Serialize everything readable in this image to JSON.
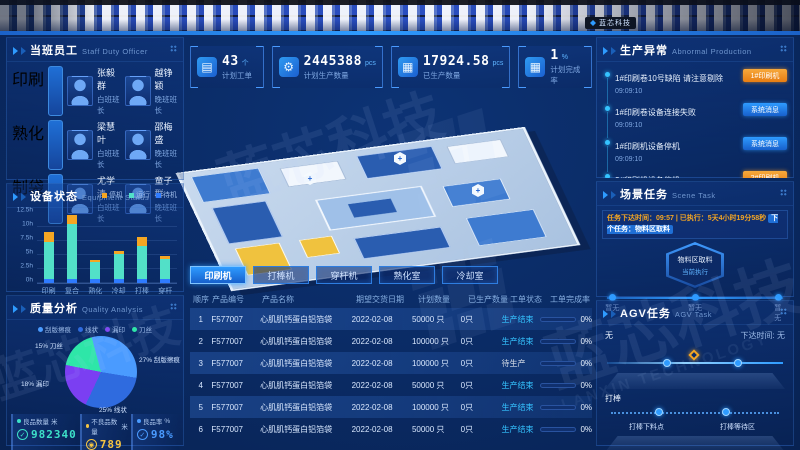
{
  "banner": {
    "logo_text": "蓝芯科技"
  },
  "watermark": {
    "cn": "蓝芯科技",
    "en": "LANXIN TECHNOLOGY"
  },
  "colors": {
    "accent_blue": "#2e9bff",
    "alert_orange": "#f5a623",
    "cyan": "#3de0c8",
    "yellow": "#f5c542",
    "panel_border": "#2f6fd1"
  },
  "staff_panel": {
    "title": "当班员工",
    "subtitle": "Staff Duty Officer",
    "groups": [
      {
        "tag": "印刷",
        "members": [
          {
            "name": "张毅群",
            "role": "白班班长"
          },
          {
            "name": "越铮颖",
            "role": "晚班班长"
          }
        ]
      },
      {
        "tag": "熟化",
        "members": [
          {
            "name": "梁慧叶",
            "role": "白班班长"
          },
          {
            "name": "邵梅盛",
            "role": "晚班班长"
          }
        ]
      },
      {
        "tag": "制袋",
        "members": [
          {
            "name": "尤学清",
            "role": "白班班长"
          },
          {
            "name": "童子群",
            "role": "晚班班长"
          }
        ]
      }
    ]
  },
  "equipment_panel": {
    "title": "设备状态",
    "subtitle": "Equipment Status"
  },
  "quality_panel": {
    "title": "质量分析",
    "subtitle": "Quality Analysis",
    "stats": [
      {
        "label": "良品数量",
        "unit": "米",
        "value": "982340",
        "color": "#3de0c8",
        "icon": "check-circle-icon",
        "glyph": "✓"
      },
      {
        "label": "不良品数量",
        "unit": "米",
        "value": "789",
        "color": "#f5c542",
        "icon": "target-circle-icon",
        "glyph": "◉"
      },
      {
        "label": "良品率",
        "unit": "%",
        "value": "98%",
        "color": "#4a9bff",
        "icon": "check-circle-icon",
        "glyph": "✓"
      }
    ]
  },
  "kpis": [
    {
      "icon": "clipboard-icon",
      "glyph": "▤",
      "value": "43",
      "unit": "个",
      "label": "计划工单"
    },
    {
      "icon": "gear-icon",
      "glyph": "⚙",
      "value": "2445388",
      "unit": "pcs",
      "label": "计划生产数量"
    },
    {
      "icon": "boxes-icon",
      "glyph": "▦",
      "value": "17924.58",
      "unit": "pcs",
      "label": "已生产数量"
    },
    {
      "icon": "boxes-icon",
      "glyph": "▦",
      "value": "1",
      "unit": "%",
      "label": "计划完成率"
    }
  ],
  "machine_tabs": [
    {
      "label": "印刷机",
      "active": true
    },
    {
      "label": "打棒机",
      "active": false
    },
    {
      "label": "穿杆机",
      "active": false
    },
    {
      "label": "熟化室",
      "active": false
    },
    {
      "label": "冷却室",
      "active": false
    }
  ],
  "orders_table": {
    "headers": [
      "顺序",
      "产品编号",
      "产品名称",
      "期望交货日期",
      "计划数量",
      "已生产数量",
      "工单状态",
      "工单完成率"
    ],
    "rows": [
      {
        "seq": "1",
        "code": "F577007",
        "name": "心肌肌钙蛋白铝箔袋",
        "date": "2022-02-08",
        "plan": "50000 只",
        "produced": "0只",
        "status": "生产结束",
        "rate": "0%"
      },
      {
        "seq": "2",
        "code": "F577007",
        "name": "心肌肌钙蛋白铝箔袋",
        "date": "2022-02-08",
        "plan": "100000 只",
        "produced": "0只",
        "status": "生产结束",
        "rate": "0%"
      },
      {
        "seq": "3",
        "code": "F577007",
        "name": "心肌肌钙蛋白铝箔袋",
        "date": "2022-02-08",
        "plan": "100000 只",
        "produced": "0只",
        "status": "待生产",
        "rate": "0%"
      },
      {
        "seq": "4",
        "code": "F577007",
        "name": "心肌肌钙蛋白铝箔袋",
        "date": "2022-02-08",
        "plan": "50000 只",
        "produced": "0只",
        "status": "生产结束",
        "rate": "0%"
      },
      {
        "seq": "5",
        "code": "F577007",
        "name": "心肌肌钙蛋白铝箔袋",
        "date": "2022-02-08",
        "plan": "100000 只",
        "produced": "0只",
        "status": "生产结束",
        "rate": "0%"
      },
      {
        "seq": "6",
        "code": "F577007",
        "name": "心肌肌钙蛋白铝箔袋",
        "date": "2022-02-08",
        "plan": "50000 只",
        "produced": "0只",
        "status": "生产结束",
        "rate": "0%"
      }
    ]
  },
  "abnormal_panel": {
    "title": "生产异常",
    "subtitle": "Abnormal Production",
    "items": [
      {
        "text": "1#印刷卷10号缺陷 请注意剔除",
        "time": "09:09:10",
        "tag": "1#印刷机",
        "tag_type": "orange"
      },
      {
        "text": "1#印刷卷设备连接失败",
        "time": "09:09:10",
        "tag": "系统消息",
        "tag_type": "blue"
      },
      {
        "text": "1#印刷机设备停机",
        "time": "09:09:10",
        "tag": "系统消息",
        "tag_type": "blue"
      },
      {
        "text": "2#印刷机设备停机",
        "time": "08:09:10",
        "tag": "2#印刷机",
        "tag_type": "orange"
      },
      {
        "text": "4#印刷机设备停机",
        "time": "08:09:10",
        "tag": "4#印刷机",
        "tag_type": "orange"
      }
    ]
  },
  "scene_panel": {
    "title": "场景任务",
    "subtitle": "Scene Task",
    "info_orange": "任务下达时间：09:57 | 已执行：5天4小时19分58秒",
    "info_blue": "下个任务：物料区取料",
    "hex_line1": "物料区取料",
    "hex_line2": "当前执行",
    "timeline": [
      "暂无",
      "暂无",
      "暂无"
    ]
  },
  "agv_panel": {
    "title": "AGV任务",
    "subtitle": "AGV Task",
    "current": "无",
    "issue_time": "下达时间: 无",
    "group_label": "打棒",
    "stations": [
      "打棒下料点",
      "打棒等待区"
    ]
  },
  "chart_data": [
    {
      "type": "bar",
      "stacked": true,
      "title": "设备状态 Equipment Status",
      "categories": [
        "印刷",
        "复合",
        "熟化",
        "冷却",
        "打棒",
        "穿杆"
      ],
      "series": [
        {
          "name": "待机",
          "color": "#2f7bff",
          "values": [
            0.8,
            0.8,
            0.8,
            0.8,
            0.8,
            0.8
          ]
        },
        {
          "name": "运行",
          "color": "#52e0c8",
          "values": [
            6.5,
            9.8,
            3.0,
            4.3,
            5.8,
            3.5
          ]
        },
        {
          "name": "停机",
          "color": "#f5a623",
          "values": [
            1.8,
            1.5,
            0.4,
            0.7,
            1.7,
            0.5
          ]
        }
      ],
      "legend_order": [
        "停机",
        "运行",
        "待机"
      ],
      "ylabel": "hours",
      "ylim": [
        0,
        12.5
      ],
      "yticks": [
        "0h",
        "2.5h",
        "5h",
        "7.5h",
        "10h",
        "12.5h"
      ],
      "legend_position": "top-right",
      "grid": true
    },
    {
      "type": "pie",
      "title": "质量分析 Quality Analysis",
      "slices": [
        {
          "label": "刮版擦痕",
          "pct": 27,
          "color": "#4a9bff"
        },
        {
          "label": "线状",
          "pct": 25,
          "color": "#2f6bdf"
        },
        {
          "label": "漏印",
          "pct": 18,
          "color": "#7b3ff2"
        },
        {
          "label": "刀丝",
          "pct": 15,
          "color": "#2ee6a8"
        }
      ],
      "legend_position": "top"
    }
  ]
}
